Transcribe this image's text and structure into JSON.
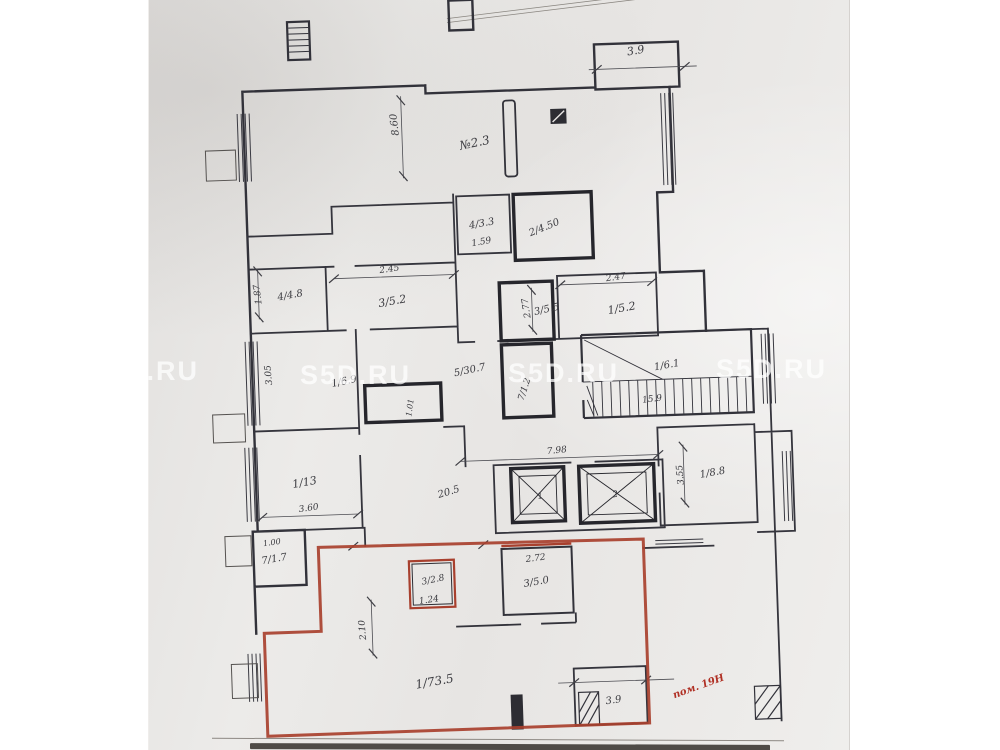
{
  "watermark": {
    "text": "S5D.RU"
  },
  "plan": {
    "colors": {
      "ink": "#3b3b40",
      "wall": "#32323a",
      "red": "#a8402e",
      "paper": "#eae8e6"
    },
    "unit_note": "пом. 19Н",
    "labels": [
      {
        "kind": "room",
        "t": "3.9",
        "x": 640,
        "y": 66,
        "r": -8,
        "s": 11
      },
      {
        "kind": "dim",
        "t": "8.60",
        "x": 399,
        "y": 128,
        "r": -95,
        "s": 10
      },
      {
        "kind": "room",
        "t": "№2.3",
        "x": 476,
        "y": 153,
        "r": -10,
        "s": 12
      },
      {
        "kind": "room",
        "t": "4/3.3",
        "x": 480,
        "y": 233,
        "r": -8,
        "s": 10
      },
      {
        "kind": "dim",
        "t": "1.59",
        "x": 479,
        "y": 251,
        "r": -8,
        "s": 9
      },
      {
        "kind": "room",
        "t": "2/4.50",
        "x": 543,
        "y": 239,
        "r": -20,
        "s": 10
      },
      {
        "kind": "dim",
        "t": "2.45",
        "x": 386,
        "y": 275,
        "r": -6,
        "s": 9
      },
      {
        "kind": "dim",
        "t": "1.87",
        "x": 256,
        "y": 293,
        "r": -95,
        "s": 9
      },
      {
        "kind": "room",
        "t": "4/4.8",
        "x": 286,
        "y": 298,
        "r": -8,
        "s": 10
      },
      {
        "kind": "room",
        "t": "3/5.2",
        "x": 388,
        "y": 308,
        "r": -8,
        "s": 11
      },
      {
        "kind": "dim",
        "t": "2.77",
        "x": 524,
        "y": 316,
        "r": -97,
        "s": 9
      },
      {
        "kind": "room",
        "t": "3/5.5",
        "x": 542,
        "y": 321,
        "r": -10,
        "s": 10
      },
      {
        "kind": "dim",
        "t": "2.47",
        "x": 612,
        "y": 291,
        "r": -6,
        "s": 9
      },
      {
        "kind": "room",
        "t": "1/5.2",
        "x": 617,
        "y": 323,
        "r": -8,
        "s": 11
      },
      {
        "kind": "dim",
        "t": "3.05",
        "x": 264,
        "y": 374,
        "r": -93,
        "s": 9
      },
      {
        "kind": "room",
        "t": "1/6.9",
        "x": 337,
        "y": 386,
        "r": -10,
        "s": 10
      },
      {
        "kind": "room",
        "t": "5/30.7",
        "x": 463,
        "y": 379,
        "r": -10,
        "s": 10
      },
      {
        "kind": "dim",
        "t": "1.01",
        "x": 404,
        "y": 412,
        "r": -80,
        "s": 8
      },
      {
        "kind": "room",
        "t": "7/1.2",
        "x": 519,
        "y": 398,
        "r": -70,
        "s": 9
      },
      {
        "kind": "room",
        "t": "1/6.1",
        "x": 660,
        "y": 381,
        "r": -8,
        "s": 10
      },
      {
        "kind": "dim",
        "t": "15.9",
        "x": 644,
        "y": 414,
        "r": -5,
        "s": 9
      },
      {
        "kind": "room",
        "t": "1/13",
        "x": 294,
        "y": 486,
        "r": -8,
        "s": 11
      },
      {
        "kind": "dim",
        "t": "3.60",
        "x": 297,
        "y": 511,
        "r": -6,
        "s": 9
      },
      {
        "kind": "dim",
        "t": "20.5",
        "x": 438,
        "y": 500,
        "r": -15,
        "s": 10
      },
      {
        "kind": "dim",
        "t": "7.98",
        "x": 547,
        "y": 462,
        "r": -4,
        "s": 9
      },
      {
        "kind": "dim",
        "t": "3.55",
        "x": 672,
        "y": 488,
        "r": -93,
        "s": 9
      },
      {
        "kind": "room",
        "t": "1/8.8",
        "x": 702,
        "y": 490,
        "r": -8,
        "s": 10
      },
      {
        "kind": "mark",
        "t": "1",
        "x": 529,
        "y": 507,
        "r": -8,
        "s": 9
      },
      {
        "kind": "mark",
        "t": "2",
        "x": 604,
        "y": 508,
        "r": -8,
        "s": 9
      },
      {
        "kind": "dim",
        "t": "1.00",
        "x": 259,
        "y": 544,
        "r": -6,
        "s": 8
      },
      {
        "kind": "room",
        "t": "7/1.7",
        "x": 261,
        "y": 561,
        "r": -8,
        "s": 10
      },
      {
        "kind": "dim",
        "t": "2.72",
        "x": 522,
        "y": 569,
        "r": -5,
        "s": 9
      },
      {
        "kind": "room",
        "t": "3/5.0",
        "x": 522,
        "y": 593,
        "r": -8,
        "s": 10
      },
      {
        "kind": "room",
        "t": "3/2.8",
        "x": 419,
        "y": 587,
        "r": -10,
        "s": 9
      },
      {
        "kind": "dim",
        "t": "1.24",
        "x": 414,
        "y": 607,
        "r": -6,
        "s": 9
      },
      {
        "kind": "dim",
        "t": "2.10",
        "x": 349,
        "y": 632,
        "r": -93,
        "s": 9
      },
      {
        "kind": "room",
        "t": "1/73.5",
        "x": 417,
        "y": 690,
        "r": -8,
        "s": 12
      },
      {
        "kind": "room",
        "t": "3.9",
        "x": 595,
        "y": 714,
        "r": -6,
        "s": 10
      },
      {
        "kind": "unit",
        "t": "пом. 19Н",
        "x": 681,
        "y": 703,
        "r": -18,
        "s": 10,
        "c": "#b03024",
        "bold": true
      }
    ]
  }
}
